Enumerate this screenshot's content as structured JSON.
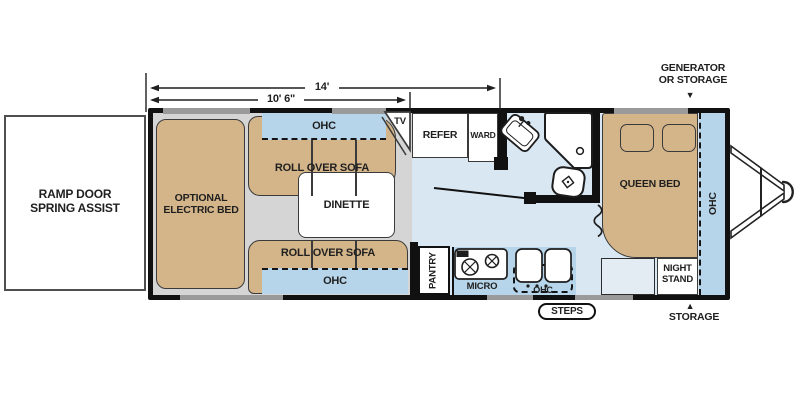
{
  "dimensions": {
    "overall": "14'",
    "slide": "10' 6\""
  },
  "callouts": {
    "generator_line1": "GENERATOR",
    "generator_line2": "OR STORAGE",
    "storage": "STORAGE",
    "steps": "STEPS",
    "ramp_line1": "RAMP DOOR",
    "ramp_line2": "SPRING ASSIST"
  },
  "rooms": {
    "electric_bed_line1": "OPTIONAL",
    "electric_bed_line2": "ELECTRIC BED",
    "roll_over_sofa": "ROLL OVER SOFA",
    "ohc": "OHC",
    "dinette": "DINETTE",
    "tv": "TV",
    "refer": "REFER",
    "ward": "WARD",
    "pantry": "PANTRY",
    "micro": "MICRO",
    "queen_bed": "QUEEN BED",
    "night_stand_line1": "NIGHT",
    "night_stand_line2": "STAND"
  },
  "icons": {
    "arrow_down": "▼",
    "arrow_up": "▲"
  },
  "colors": {
    "floor_blue": "#d9e7f2",
    "slide_floor_gray": "#d5d5d5",
    "furniture_tan": "#d4b58a",
    "cabinet_blue": "#b7d5ea",
    "wall_black": "#111111",
    "window_gray": "#9a9a9a"
  }
}
